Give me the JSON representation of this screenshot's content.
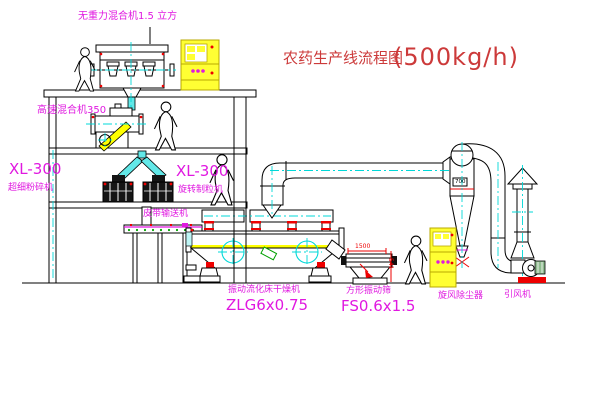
{
  "title": {
    "text": "农药生产线流程图",
    "capacity": "(500kg/h)"
  },
  "labels": {
    "top_mixer": "无重力混合机1.5 立方",
    "high_speed_mixer": "高速混合机350",
    "mill_model": "XL-300",
    "mill_name": "超细粉碎机",
    "granulator_model": "XL-300",
    "granulator_name": "旋转制粒机",
    "belt_conveyor": "皮带输送机",
    "dryer_name": "振动流化床干燥机",
    "dryer_model": "ZLG6x0.75",
    "screen_name": "方形振动筛",
    "screen_model": "FS0.6x1.5",
    "cyclone": "旋风除尘器",
    "fan": "引风机"
  },
  "dimensions": {
    "screen_length": "1500",
    "screen_height": "541",
    "cyclone_diameter": "700"
  },
  "colors": {
    "line": "#000000",
    "centerline": "#00d8d8",
    "label": "#e018e0",
    "title": "#cc3a3a",
    "accent_red": "#ee0000",
    "cabinet_yellow": "#ffff33",
    "dot_green": "#00a000"
  }
}
